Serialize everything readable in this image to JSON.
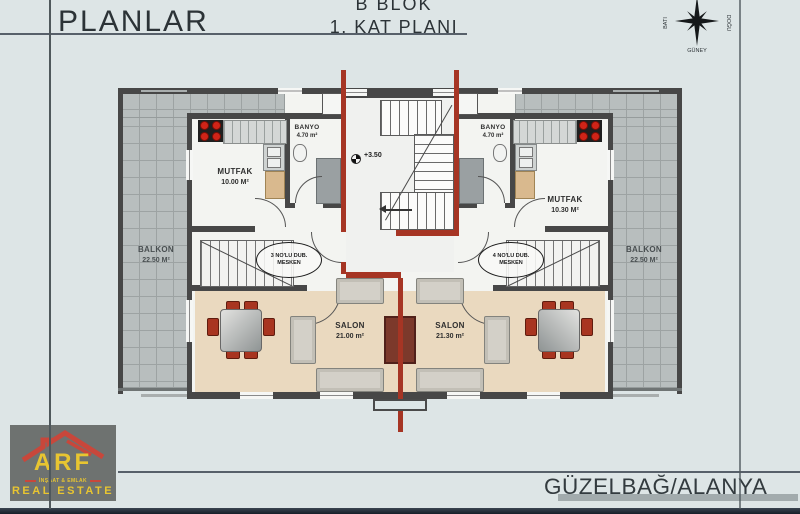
{
  "header": {
    "title": "PLANLAR",
    "block": "B BLOK",
    "floor": "1. KAT PLANI"
  },
  "compass": {
    "west": "BATI",
    "east": "DOĞU",
    "south": "GÜNEY"
  },
  "footer": {
    "location": "GÜZELBAĞ/ALANYA"
  },
  "logo": {
    "brand": "ARF",
    "tagline": "İNŞAAT & EMLAK",
    "subtitle": "REAL ESTATE"
  },
  "plan": {
    "level_marker": "+3.50",
    "units": [
      {
        "kitchen_name": "MUTFAK",
        "kitchen_area": "10.00 M²",
        "bath_name": "BANYO",
        "bath_area": "4.70 m²",
        "living_name": "SALON",
        "living_area": "21.00 m²",
        "balcony_name": "BALKON",
        "balcony_area": "22.50 M²",
        "tag_line1": "3 NO'LU DUB.",
        "tag_line2": "MESKEN"
      },
      {
        "kitchen_name": "MUTFAK",
        "kitchen_area": "10.30 M²",
        "bath_name": "BANYO",
        "bath_area": "4.70 m²",
        "living_name": "SALON",
        "living_area": "21.30 m²",
        "balcony_name": "BALKON",
        "balcony_area": "22.50 M²",
        "tag_line1": "4 NO'LU DUB.",
        "tag_line2": "MESKEN"
      }
    ]
  },
  "colors": {
    "sheet_bg": "#dde5e6",
    "wall": "#474747",
    "red_line": "#a63524",
    "salon_floor": "#ead9bf",
    "tile": "#b8bebe",
    "brand_yellow": "#e8c531",
    "brand_red": "#c8473b"
  }
}
